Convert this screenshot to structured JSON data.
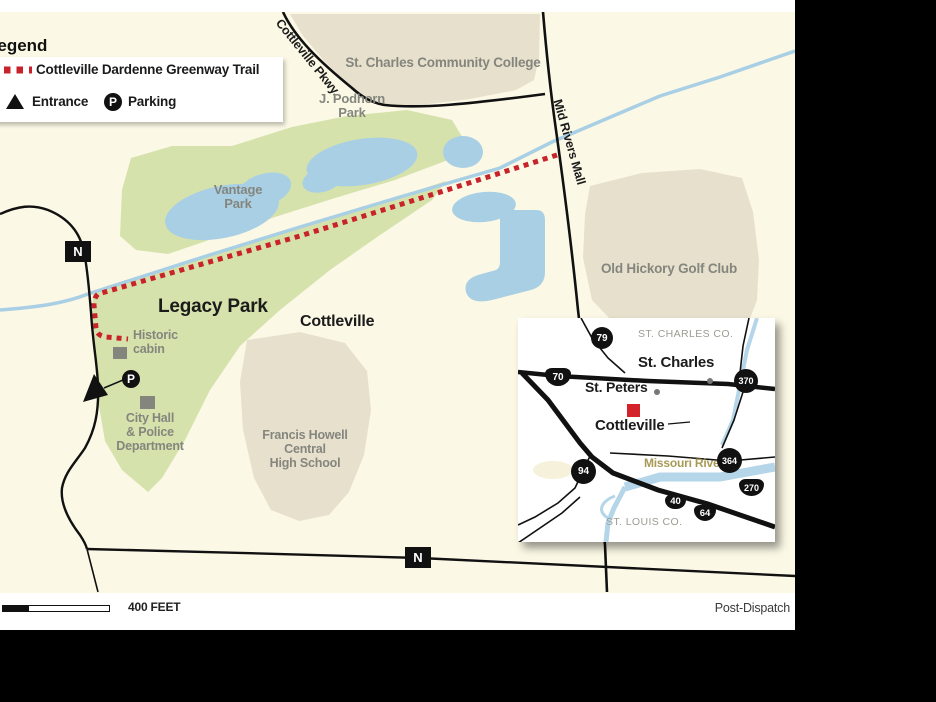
{
  "page": {
    "credit": "Post-Dispatch"
  },
  "legend": {
    "title": "Legend",
    "trail": "Cottleville Dardenne Greenway Trail",
    "entrance": "Entrance",
    "parking": "Parking",
    "parking_symbol": "P"
  },
  "scale": {
    "label": "400 FEET"
  },
  "roads": {
    "route_n": "N",
    "cottleville_pkwy": "Cottleville Pkwy.",
    "mid_rivers_mall": "Mid Rivers Mall"
  },
  "places": {
    "college": "St. Charles Community College",
    "podhorn": "J. Podhorn\nPark",
    "vantage": "Vantage\nPark",
    "golf": "Old Hickory Golf Club",
    "legacy": "Legacy Park",
    "cottleville": "Cottleville",
    "cabin": "Historic\ncabin",
    "city_hall": "City Hall\n& Police\nDepartment",
    "school": "Francis Howell\nCentral\nHigh School"
  },
  "inset": {
    "st_charles_co": "ST. CHARLES CO.",
    "st_louis_co": "ST. LOUIS CO.",
    "st_charles": "St. Charles",
    "st_peters": "St. Peters",
    "cottleville": "Cottleville",
    "missouri_river": "Missouri River",
    "sh_79": "79",
    "sh_70": "70",
    "sh_370": "370",
    "sh_364": "364",
    "sh_270": "270",
    "sh_94": "94",
    "sh_40": "40",
    "sh_64": "64"
  },
  "colors": {
    "trail_red": "#C8232A",
    "water_blue": "#A9CFE5",
    "park_green": "#D6E2AC",
    "land_tan": "#E7E0CC",
    "map_cream": "#FBF8E5",
    "label_gray": "#84867E"
  }
}
